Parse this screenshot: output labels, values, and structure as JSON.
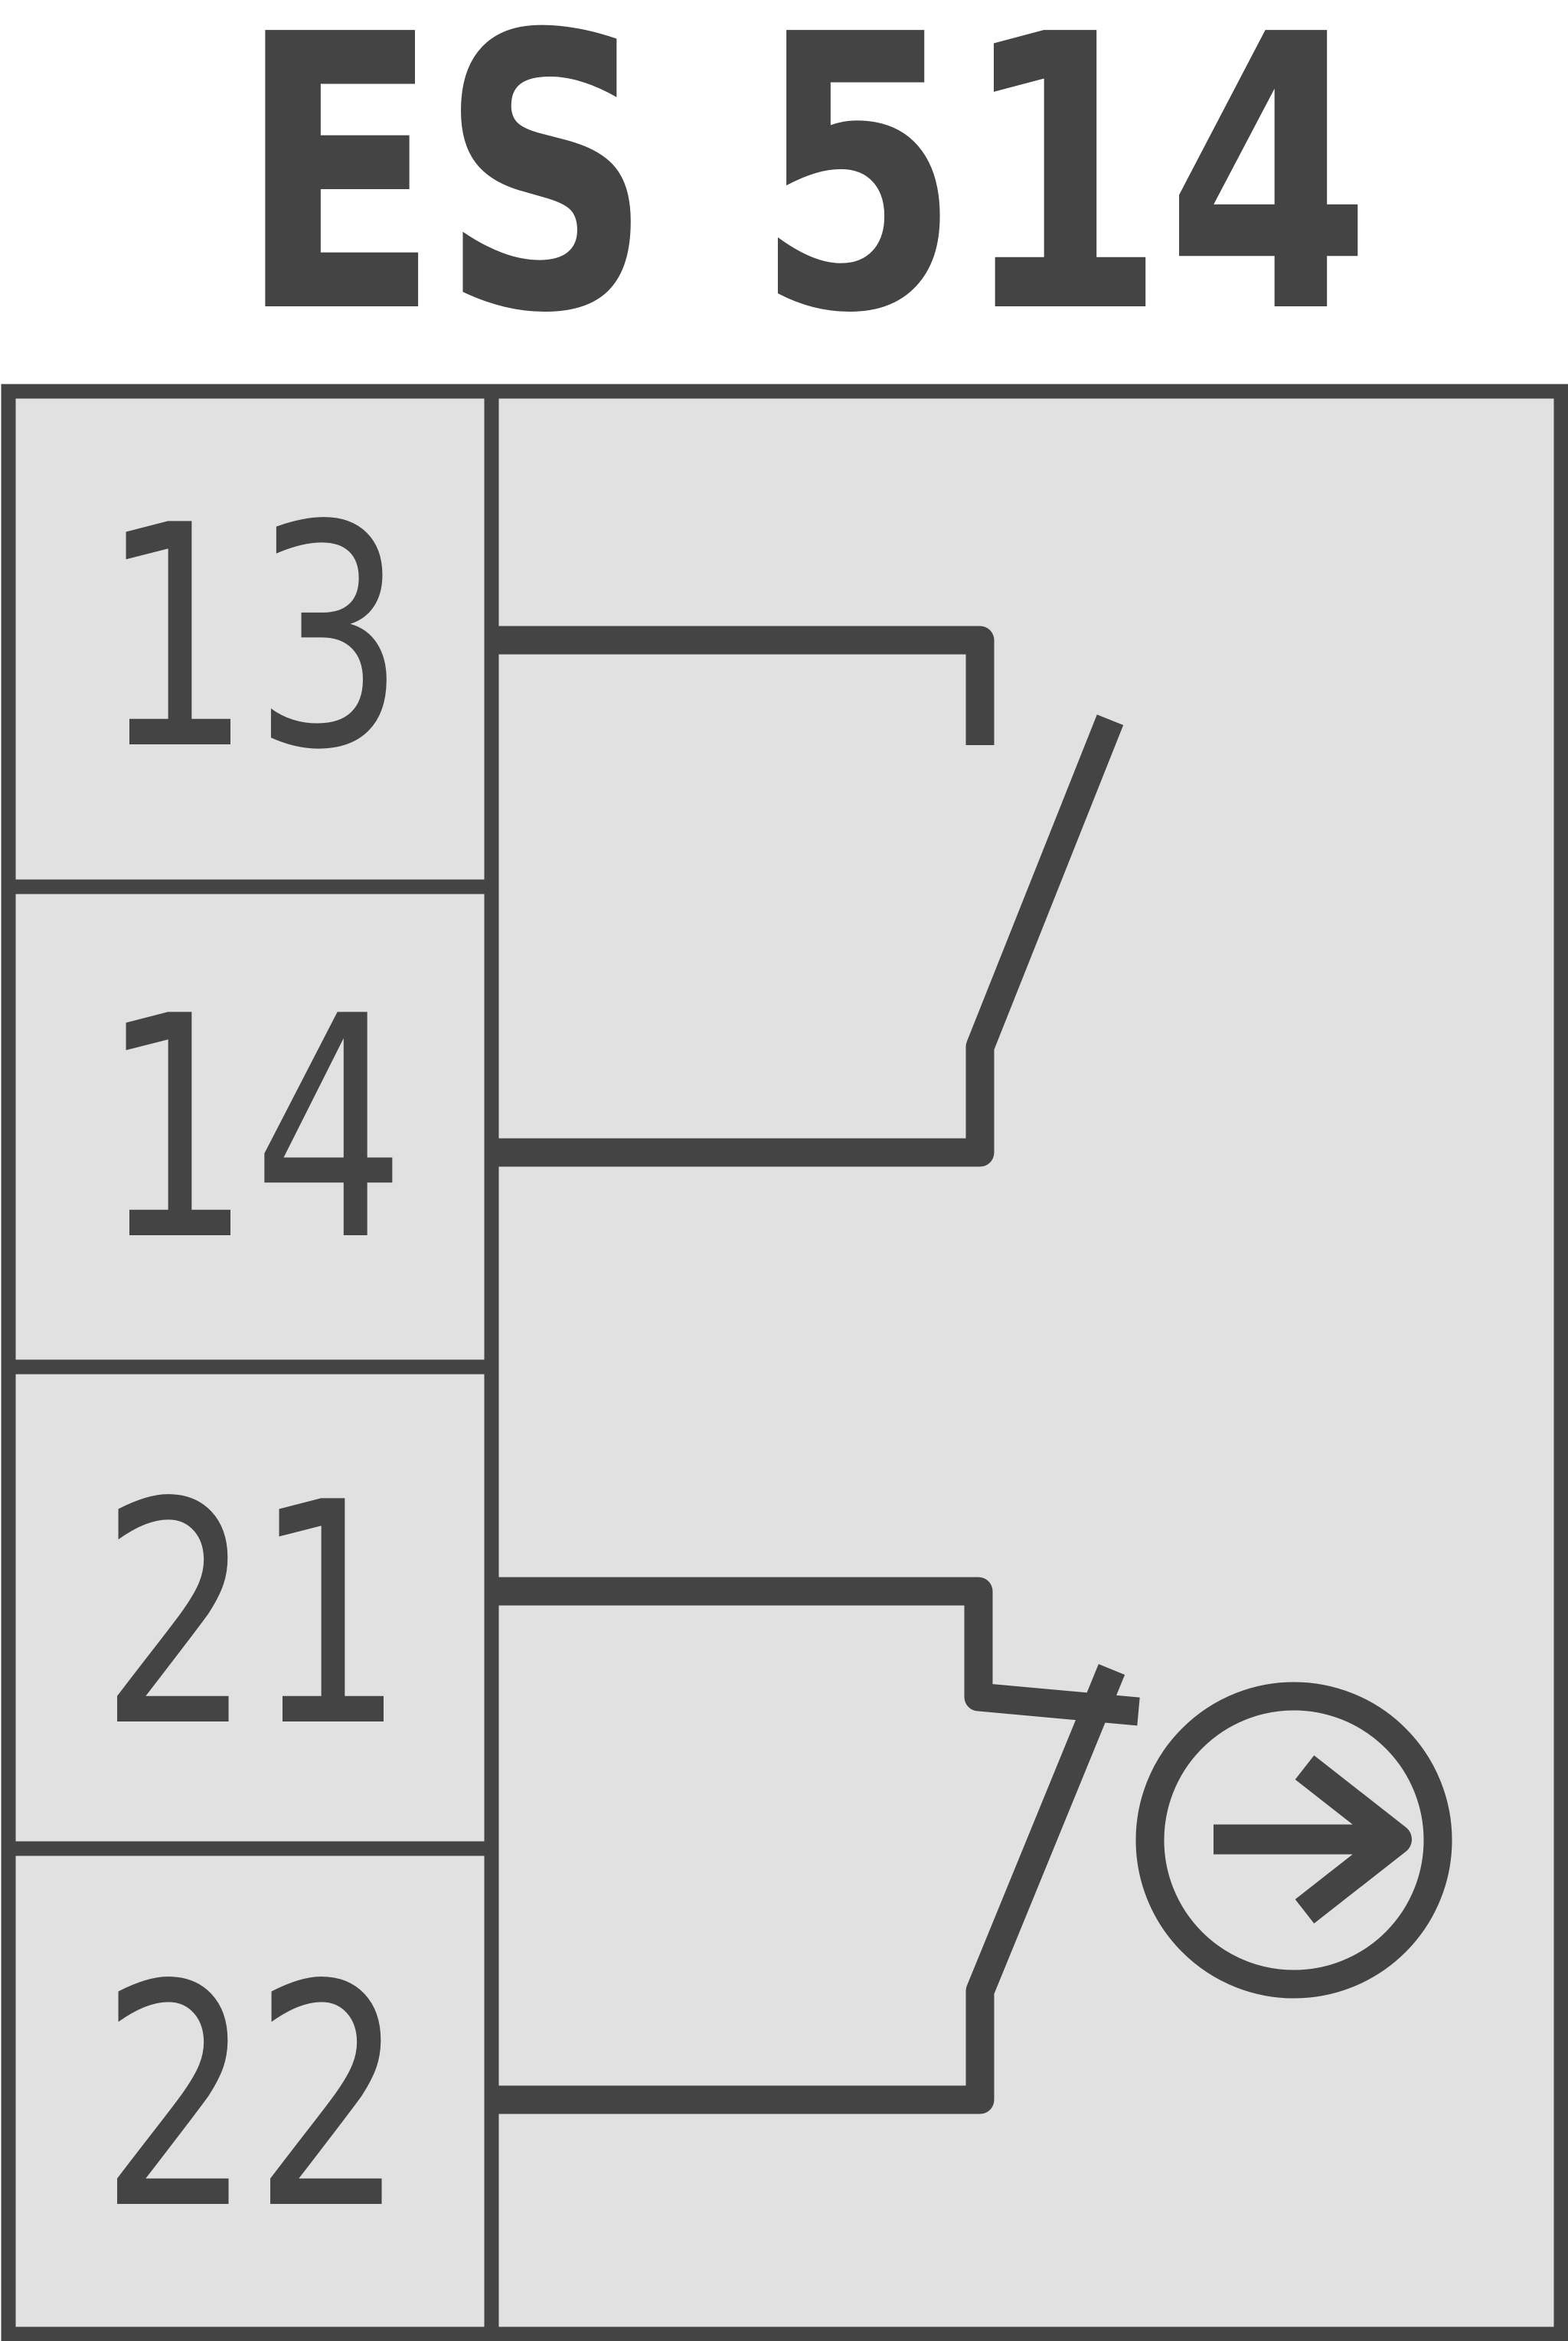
{
  "title": "ES 514",
  "colors": {
    "line": "#444444",
    "panel": "#e1e1e1",
    "page": "#ffffff"
  },
  "terminal_block": {
    "terminals": [
      {
        "label": "13"
      },
      {
        "label": "14"
      },
      {
        "label": "21"
      },
      {
        "label": "22"
      }
    ]
  },
  "schematic": {
    "contacts": [
      {
        "terminals": [
          "13",
          "14"
        ]
      },
      {
        "terminals": [
          "21",
          "22"
        ],
        "icon": "arrow-right-circle-icon"
      }
    ]
  }
}
